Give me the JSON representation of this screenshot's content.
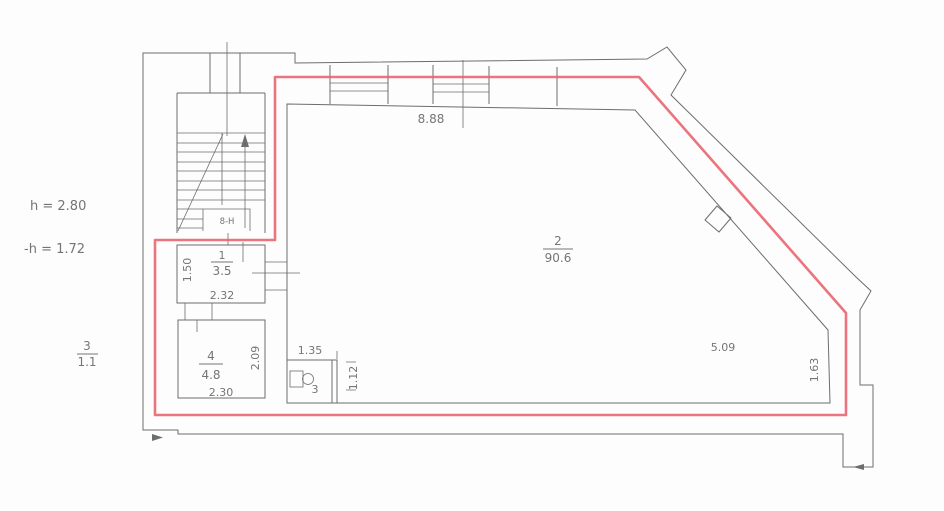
{
  "drawing": {
    "annotations": {
      "height_note": "h  =  2.80",
      "reduced_height_note": "-h  =  1.72"
    },
    "legend": {
      "room_number": "3",
      "room_area": "1.1"
    },
    "rooms": {
      "room1": {
        "number": "1",
        "area": "3.5",
        "width_dim": "2.32",
        "depth_dim": "1.50"
      },
      "room2": {
        "number": "2",
        "area": "90.6"
      },
      "room4": {
        "number": "4",
        "area": "4.8",
        "width_dim": "2.30",
        "depth_dim": "2.09"
      },
      "wc": {
        "number": "3",
        "width_dim": "1.35",
        "depth_dim": "1.12"
      }
    },
    "dims": {
      "top_wall": "8.88",
      "diagonal_wall": "5.09",
      "right_wall": "1.63"
    },
    "stair_label": "8-H",
    "colors": {
      "boundary": "#e8626c",
      "wall": "#6d6d6d"
    }
  }
}
